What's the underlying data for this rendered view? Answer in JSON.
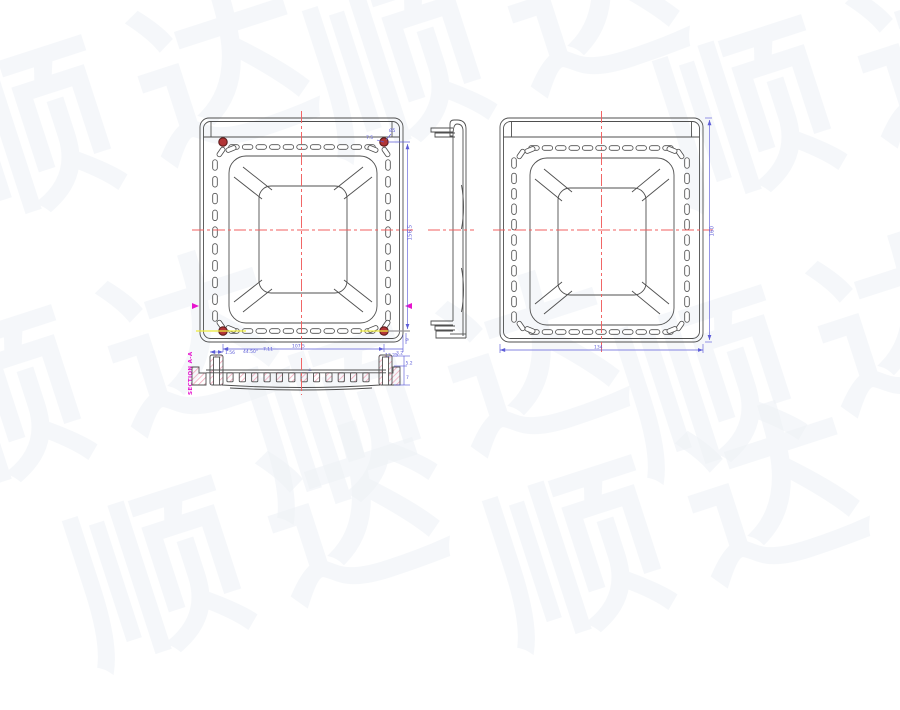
{
  "watermark": {
    "text": "顺达"
  },
  "colors": {
    "line": "#4f4f4f",
    "dimension": "#5d5dd8",
    "centerline": "#f15f5f",
    "section_label": "#e714ce",
    "highlight_yellow": "#efec3c",
    "corner_dot": "#b23536",
    "hatch": "#f2a3b8"
  },
  "views": {
    "top": {
      "dims": {
        "inner_width": "107.5",
        "right_offset": "13.25",
        "height": "156.5",
        "corner_offset": "7.5",
        "corner_diameter": "Ø5",
        "edge_depth": "9",
        "step": "1.56",
        "angle": "44.50°",
        "lead": "7.11"
      }
    },
    "back": {
      "dims": {
        "width": "134",
        "height": "160"
      }
    },
    "section": {
      "label": "SECTION A-A",
      "perp_mark": "⊥",
      "dims": {
        "rib": "3.2",
        "boss": "5.2",
        "depth": "7"
      }
    }
  }
}
